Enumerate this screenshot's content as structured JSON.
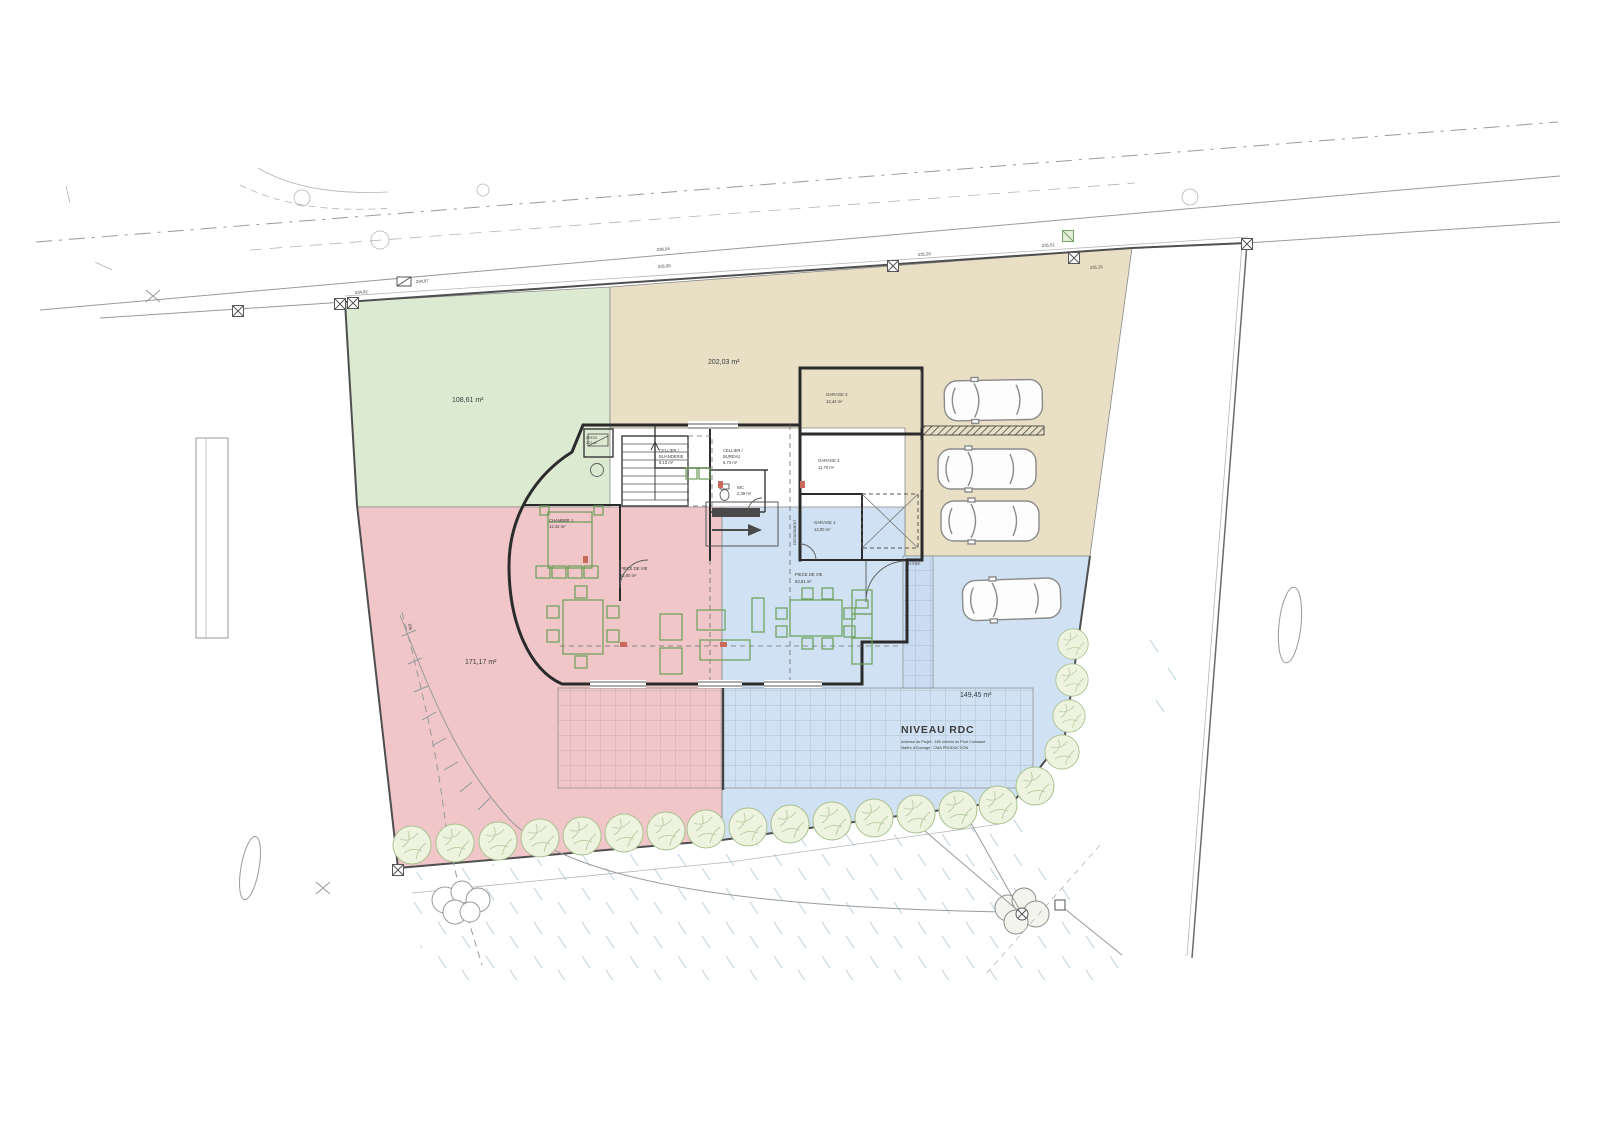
{
  "plan": {
    "title": "NIVEAU RDC",
    "address_line": "Adresse du Projet : 185 chemin du Pont Croissant",
    "owner_line": "Maître d'Ouvrage : CMA PRODUCTION",
    "slope_label": "5%"
  },
  "zones": {
    "green": {
      "label": "108,61 m²",
      "color": "#dcead2",
      "text_color": "#3a56c4"
    },
    "tan": {
      "label": "202,03 m²",
      "color": "#e8dfc4",
      "text_color": "#4a4a4a"
    },
    "red": {
      "label": "171,17 m²",
      "color": "#f0c6c9",
      "text_color": "#3c3c3c"
    },
    "blue": {
      "label": "149,45 m²",
      "color": "#cfe1f2",
      "text_color": "#3c3c3c"
    }
  },
  "rooms": {
    "chambre1": {
      "name": "CHAMBRE 1",
      "area": "12,42 m²"
    },
    "cellier_buanderie": {
      "line1": "CELLIER /",
      "line2": "BUANDERIE",
      "area": "5,10 m²"
    },
    "cellier_bureau": {
      "line1": "CELLIER /",
      "line2": "BUREAU",
      "area": "5,73 m²"
    },
    "wc": {
      "name": "WC",
      "area": "2,39 m²"
    },
    "piece_de_vie_1": {
      "name": "PIECE DE VIE",
      "area": "62,80 m²"
    },
    "piece_de_vie_2": {
      "name": "PIECE DE VIE",
      "area": "63,81 m²"
    },
    "garage1": {
      "name": "GARAGE 1",
      "area": "12,00 m²"
    },
    "garage2": {
      "name": "GARAGE 2",
      "area": "11,70 m²"
    },
    "garage3": {
      "name": "GARAGE 3",
      "area": "12,44 m²"
    },
    "entree": {
      "name": "ENTREE"
    },
    "dressing": {
      "name": "DRESS.",
      "area": "2,27 m²"
    },
    "degagement": {
      "name": "DEGAGEMENT"
    }
  },
  "elevations": [
    "234,92",
    "234,87",
    "236,04",
    "235,95",
    "235,28",
    "235,51",
    "235,15"
  ]
}
